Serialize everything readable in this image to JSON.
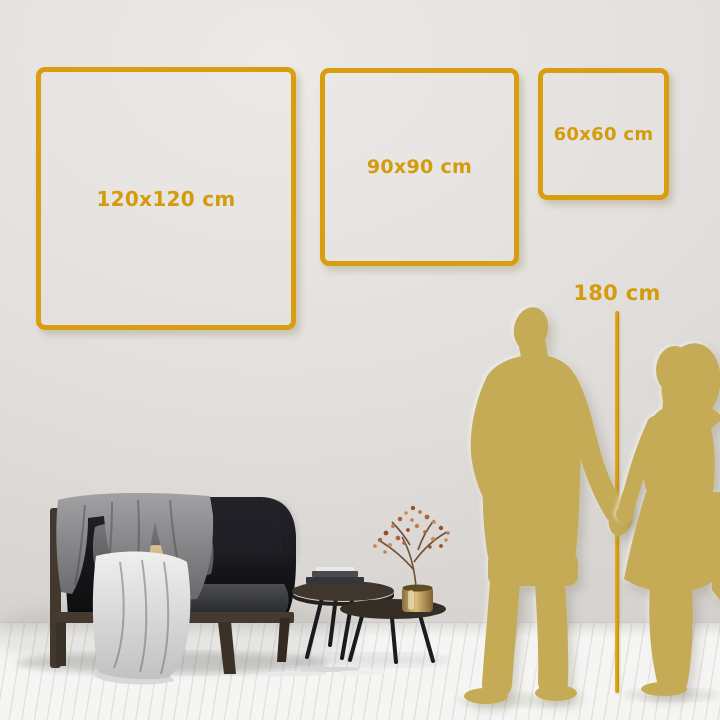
{
  "size_guide": {
    "frames": [
      {
        "id": "frame-120",
        "label": "120x120 cm"
      },
      {
        "id": "frame-90",
        "label": "90x90 cm"
      },
      {
        "id": "frame-60",
        "label": "60x60 cm"
      }
    ],
    "height_reference": {
      "label": "180 cm"
    }
  },
  "scene": {
    "objects": [
      "sofa",
      "throw-blanket",
      "pillows",
      "seat-cushion",
      "nesting-coffee-tables",
      "books",
      "brass-vase",
      "dried-branch",
      "couple-silhouette",
      "plank-floor",
      "wall"
    ]
  },
  "colors": {
    "frame_gold": "#D89E10",
    "label_gold": "#D49B0C",
    "measure_line_gold": "#E0A512",
    "silhouette_gold": "#C6AB57",
    "wall_gray": "#E3E0DD",
    "floor_white": "#F3F3F2",
    "sofa_charcoal": "#17171A",
    "pillow_tan": "#C9AC7C"
  }
}
